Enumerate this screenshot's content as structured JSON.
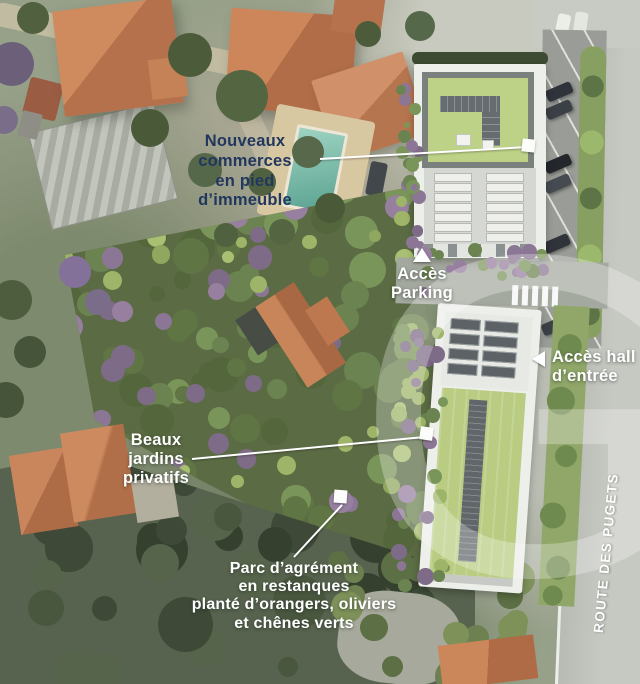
{
  "scene": {
    "type": "aerial-development-site-plan"
  },
  "annotations": {
    "commerces": {
      "label": "Nouveaux\ncommerces\nen pied\nd’immeuble"
    },
    "parking": {
      "label": "Accès\nParking"
    },
    "hall": {
      "label": "Accès hall\nd’entrée"
    },
    "jardins": {
      "label": "Beaux\njardins\nprivatifs"
    },
    "parc": {
      "label": "Parc d’agrément\nen restanques\nplanté d’orangers, oliviers\net chênes verts"
    },
    "route": {
      "label": "ROUTE DES PUGETS"
    }
  },
  "watermark": {
    "letter": "G"
  },
  "colors": {
    "label_navy": "#21375e",
    "label_white": "#ffffff",
    "leader_line": "#ffffff",
    "green_roof": "#bdd187",
    "solar_panel": "#60666a",
    "terracotta_roof": "#c07a52",
    "road": "#c6c8c2"
  }
}
